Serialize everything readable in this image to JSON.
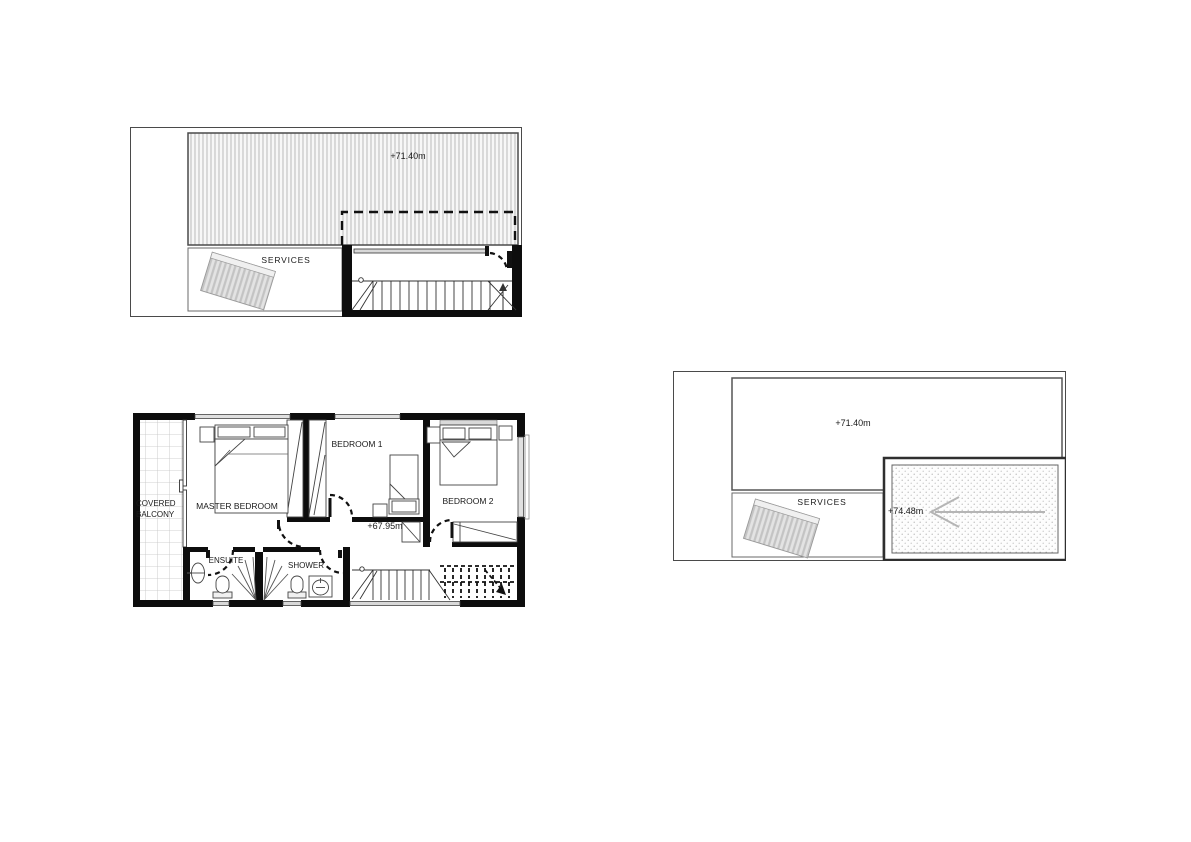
{
  "document": {
    "background": "#ffffff",
    "description": "Architectural drawing sheet with three plans"
  },
  "roof_plan_left": {
    "roof_level_label": "+71.40m",
    "services_label": "SERVICES"
  },
  "first_floor_plan": {
    "balcony_label": "COVERED BALCONY",
    "master_bedroom_label": "MASTER BEDROOM",
    "bedroom1_label": "BEDROOM 1",
    "bedroom2_label": "BEDROOM 2",
    "ensuite_label": "ENSUITE",
    "shower_label": "SHOWER",
    "floor_level_label": "+67.95m"
  },
  "roof_plan_right": {
    "roof_level_label": "+71.40m",
    "services_label": "SERVICES",
    "ramp_level_label": "+74.48m"
  },
  "colors": {
    "wall": "#0d0d0d",
    "line": "#444444",
    "roof_stripe": "#b4b4b4",
    "panel_fill": "#e3e3e3",
    "window_fill": "#e0e0e0",
    "ramp_dot": "#999999",
    "arrow_gray": "#b5b5b5",
    "background": "#ffffff"
  }
}
